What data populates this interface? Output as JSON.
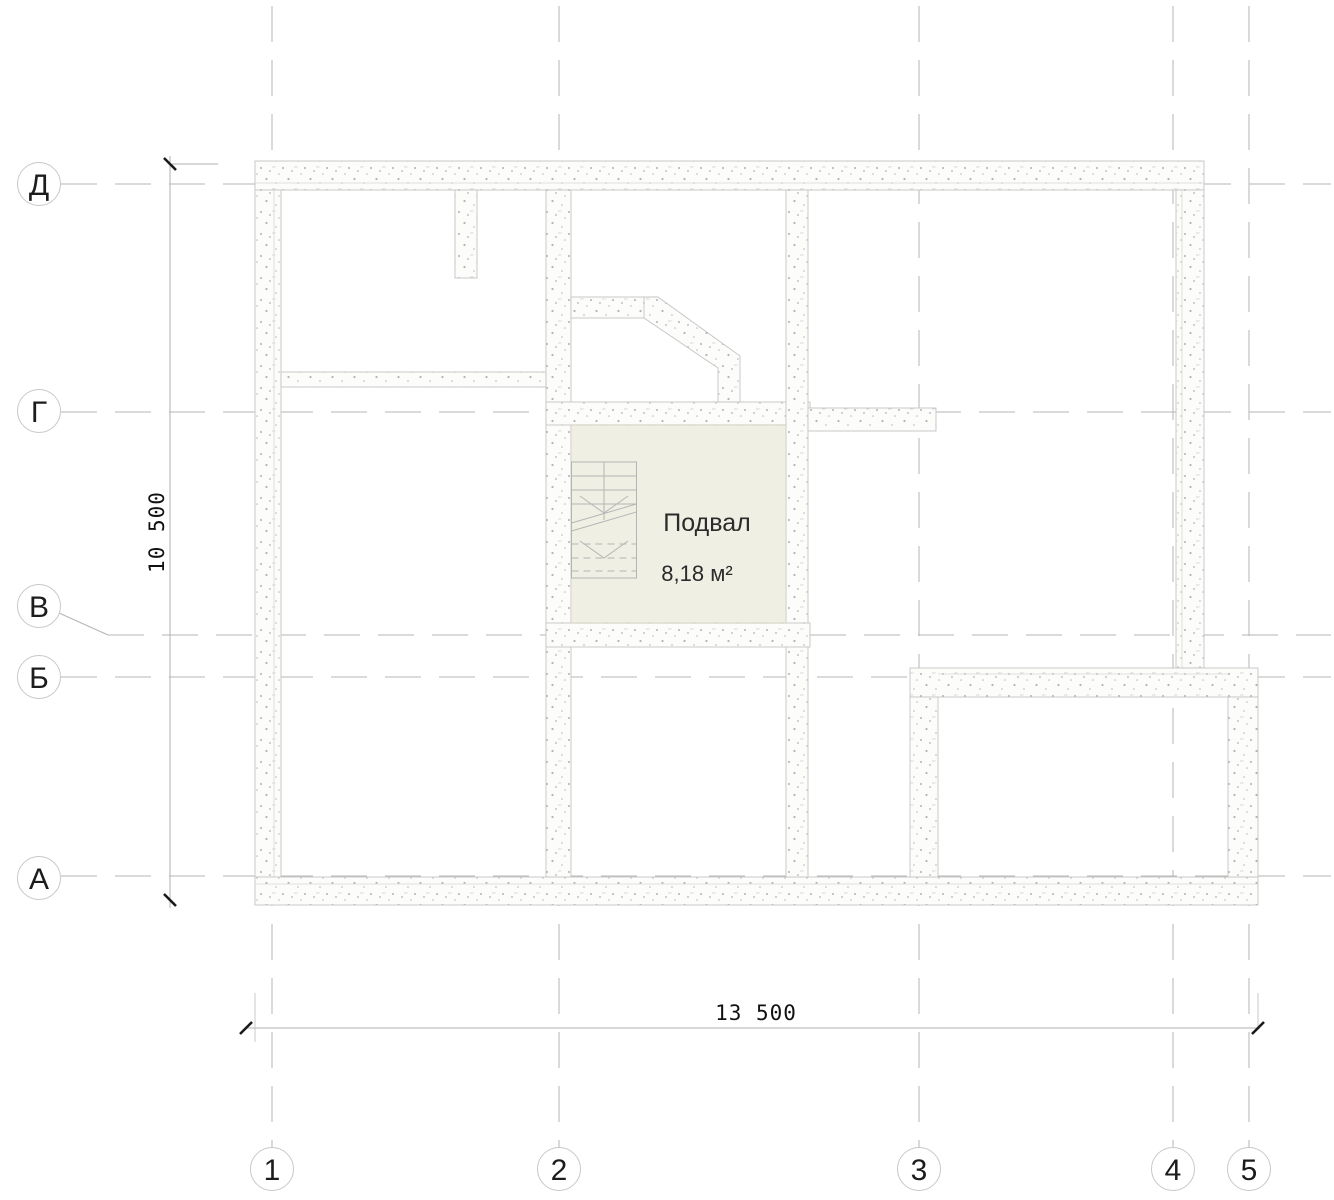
{
  "drawing": {
    "type": "architectural-floor-plan",
    "room": {
      "name": "Подвал",
      "area": "8,18 м²"
    },
    "dimensions": {
      "width_mm": "13 500",
      "height_mm": "10 500"
    },
    "grid": {
      "rows": [
        "Д",
        "Г",
        "В",
        "Б",
        "А"
      ],
      "cols": [
        "1",
        "2",
        "3",
        "4",
        "5"
      ]
    },
    "colors": {
      "basement_fill": "#f0efe3",
      "wall_outline": "#c5c5c5",
      "stipple_dot": "#b2b2b2",
      "grid_line": "#b4b4b4",
      "dim_tick": "#1a1a1a",
      "text": "#2b2b2b"
    }
  }
}
